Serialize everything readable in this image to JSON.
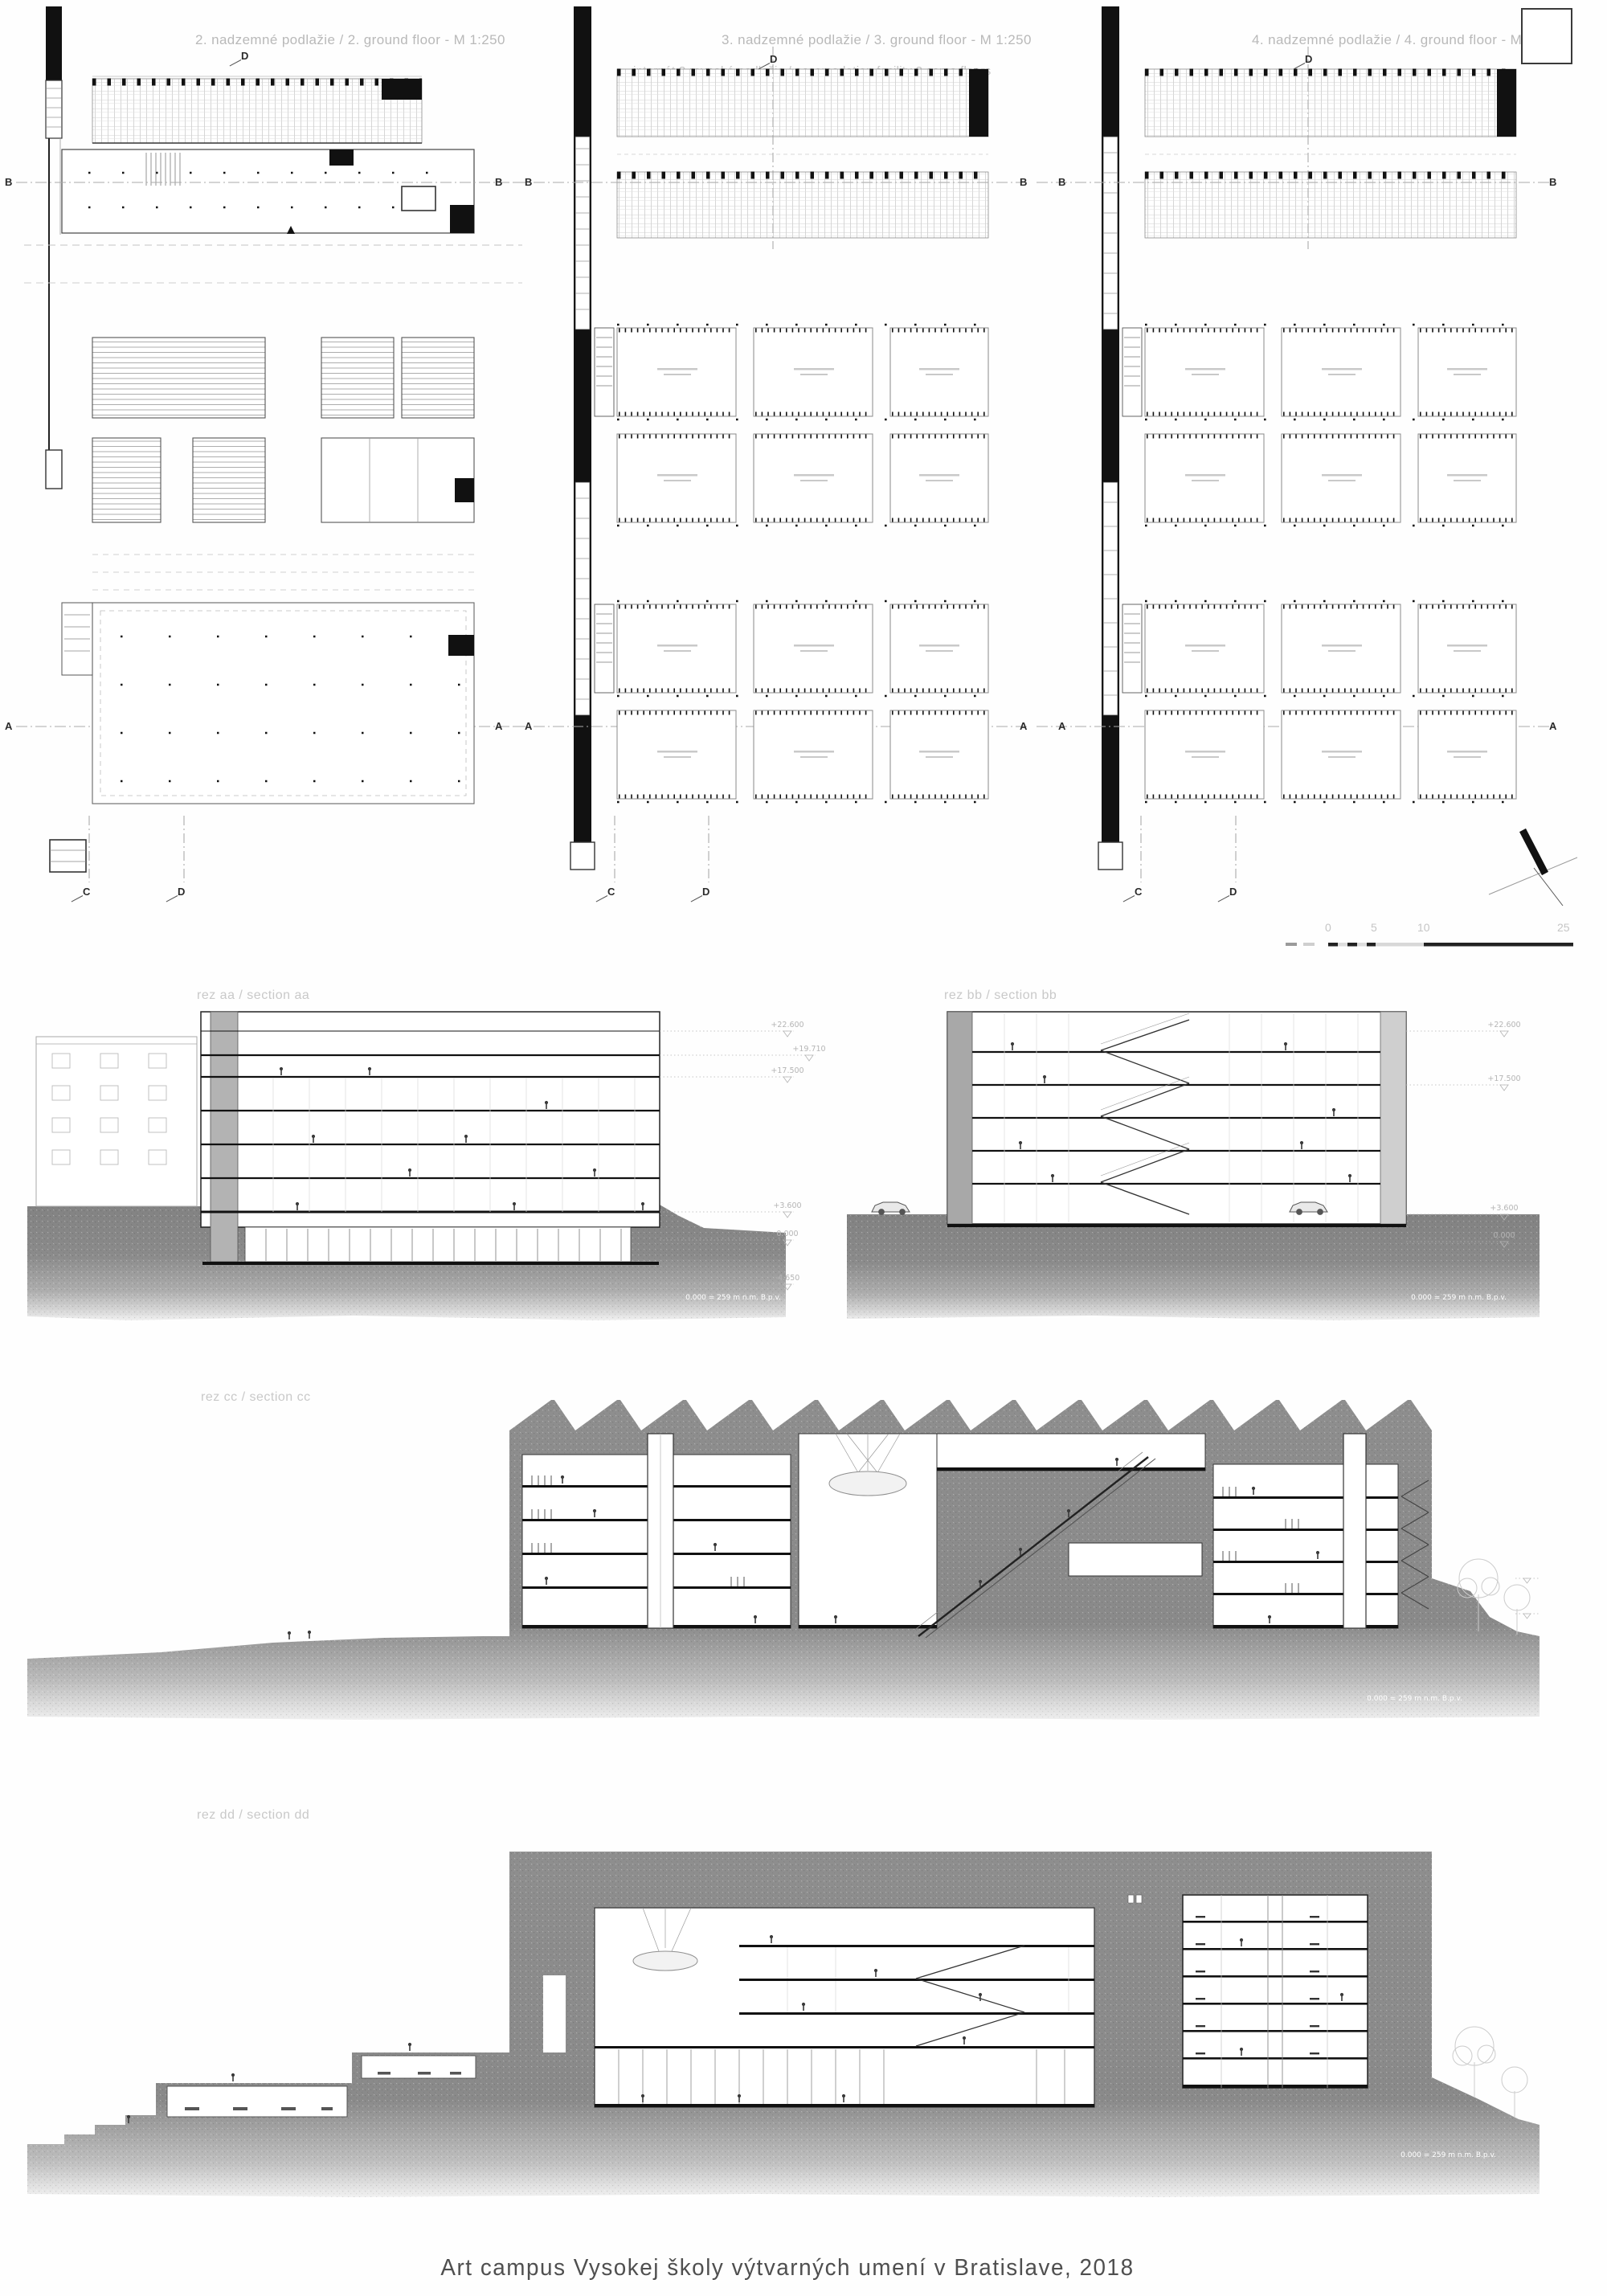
{
  "board": {
    "caption": "Art campus Vysokej školy výtvarných umení v Bratislave, 2018"
  },
  "plans": [
    {
      "title": "2. nadzemné podlažie / 2. ground floor - M 1:250",
      "subtitle": ""
    },
    {
      "title": "3. nadzemné podlažie / 3. ground floor - M 1:250",
      "subtitle": "internát 3 rovnaké podlažia / accomodation facility 3 same floors"
    },
    {
      "title": "4. nadzemné podlažie / 4. ground floor - M 1:250",
      "subtitle": ""
    }
  ],
  "plan_markers": {
    "b": "B",
    "a": "A",
    "c": "C",
    "d": "D"
  },
  "sections": [
    {
      "label": "rez aa / section aa",
      "datum_note": "0.000 = 259 m n.m. B.p.v."
    },
    {
      "label": "rez bb / section bb",
      "datum_note": "0.000 = 259 m n.m. B.p.v."
    },
    {
      "label": "rez cc / section cc",
      "datum_note": "0.000 = 259 m n.m. B.p.v."
    },
    {
      "label": "rez dd / section dd",
      "datum_note": "0.000 = 259 m n.m. B.p.v."
    }
  ],
  "elevation_marks": [
    "+22.600",
    "+19.710",
    "+17.500",
    "+3.600",
    "0.000",
    "-4.650"
  ],
  "scalebar": {
    "labels": [
      "0",
      "5",
      "10",
      "25"
    ]
  },
  "colors": {
    "terrain": "#8a8a8a",
    "line": "#1a1a1a",
    "muted_text": "#bdbdbd",
    "caption_text": "#4f4f4f"
  }
}
